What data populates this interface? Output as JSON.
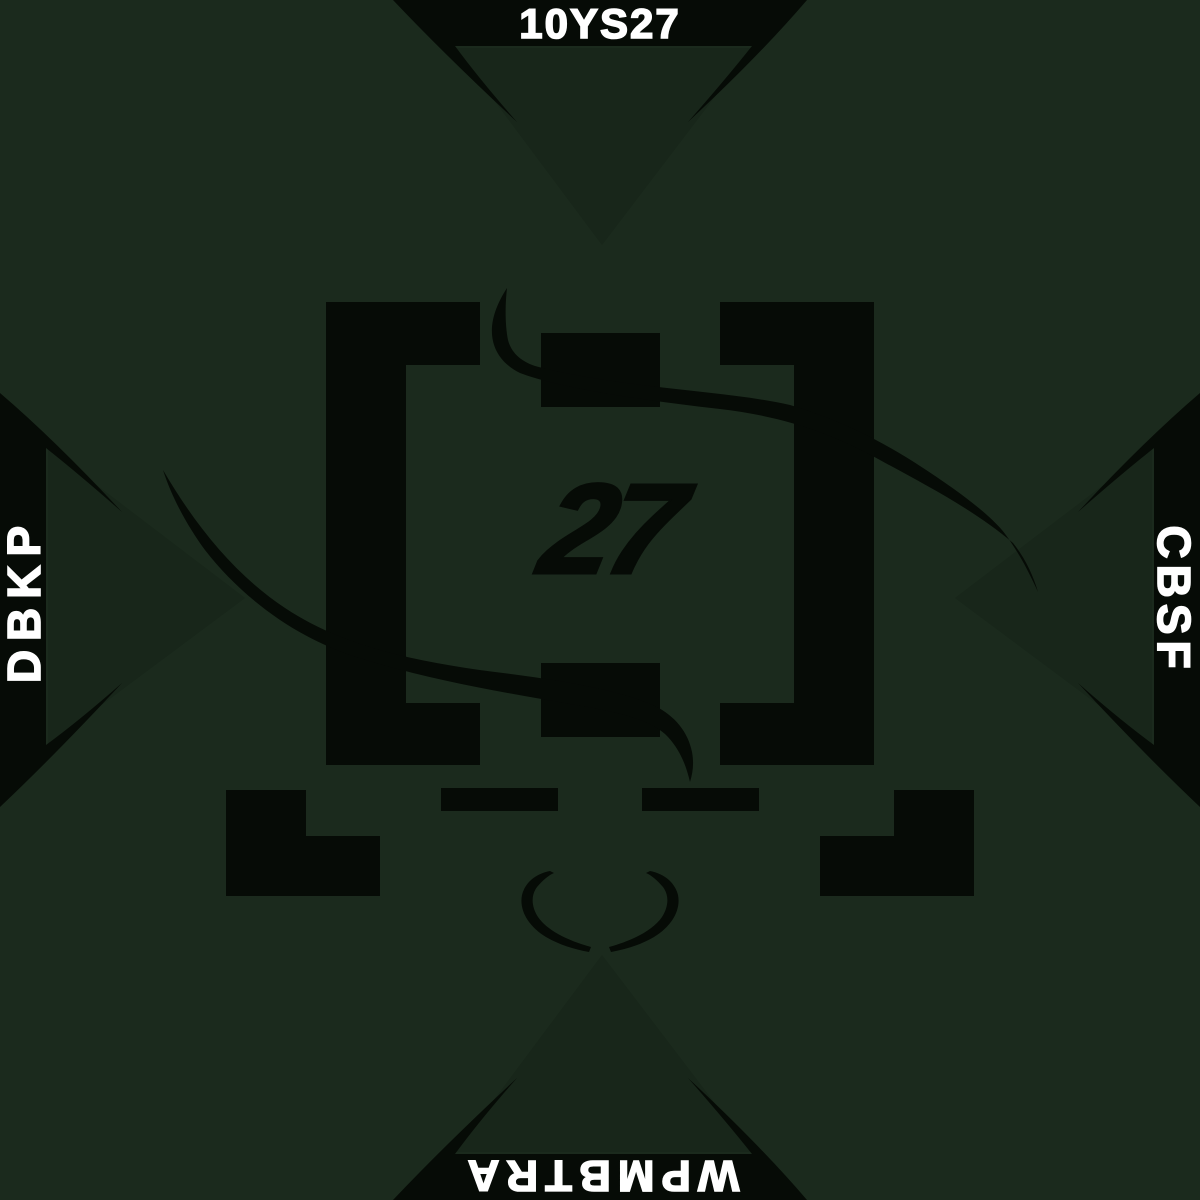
{
  "artwork": {
    "title_top": "10YS27",
    "label_left": "DBKP",
    "label_right": "CBSF",
    "label_bottom": "WPMBTRA",
    "center_number": "27"
  },
  "colors": {
    "background": "#1b2a1d",
    "fold_shade": "#18261a",
    "ink": "#060b06",
    "text": "#ffffff"
  }
}
